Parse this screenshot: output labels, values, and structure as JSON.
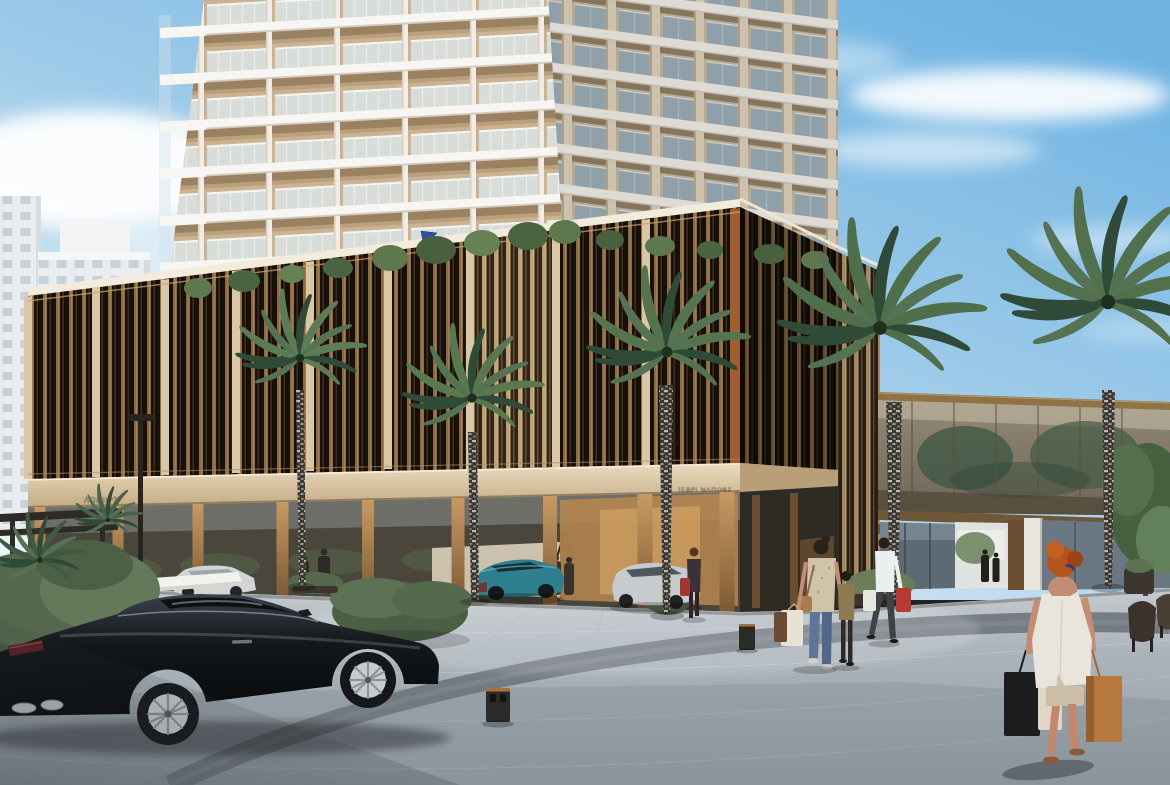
{
  "meta": {
    "domain": "Natural-Image",
    "kind": "architectural-exterior-render",
    "alt": "Daytime photorealistic rendering of a luxury mixed-use development: white residential tower with glass balconies above a bronze-louvred retail podium, palm-lined pedestrian plaza, shoppers with bags, a black luxury coupe in the foreground and a glazed sky-bridge on the right."
  },
  "scene": {
    "description": "Daytime rendering of a luxury residential tower with stacked white balconies rising above a two-storey retail podium wrapped in dark bronze vertical louvres; a palm-lined paved plaza with shoppers, parked luxury cars and a glazed sky-bridge connects the buildings.",
    "time_of_day": "day, clear blue sky with soft clouds",
    "signs": {
      "left": "ΛΟΩΙΙΡΣ",
      "center": "ΊΕΒΡΙ ΝΛΠΟΒΣ",
      "note": "fascia signage is illegible in the source render"
    },
    "elements": [
      "sky",
      "clouds",
      "distant white buildings",
      "residential tower with balconies",
      "bronze louvred retail podium",
      "storefront colonnade",
      "fascia signage",
      "blue pennant flag",
      "glazed sky-bridge",
      "palm trees",
      "pedestrian plaza",
      "curved paver band",
      "hedges and planters",
      "white entrance canopy",
      "street lamp pole",
      "litter bins",
      "outdoor chairs"
    ],
    "people": [
      "red-haired woman in white top carrying three shopping bags (foreground right)",
      "woman in jeans with child, carrying shopping bags (center)",
      "man in white shirt with red shopping bag (center right)",
      "woman in dark jacket with red bag (center left)",
      "doormen silhouettes at the entrance",
      "two figures beneath the sky-bridge"
    ],
    "vehicles": [
      "black luxury coupe (foreground)",
      "teal sports coupe",
      "silver car at entrance",
      "silver car behind hedge"
    ],
    "palette": {
      "sky_blue": "#79b5e3",
      "tower_white": "#f6f4f0",
      "balcony_beige": "#d2bb9a",
      "louver_bronze": "#8f6a3c",
      "louver_gold": "#d9ab70",
      "podium_dark": "#1b140d",
      "fascia_beige": "#e3d4b4",
      "plaza_gray": "#aab3ba",
      "paver_band_gray": "#6e757c",
      "palm_green": "#55744e",
      "trunk_gray": "#33312d",
      "car_black": "#14171b",
      "car_teal": "#2f808e",
      "car_silver": "#c9ccce",
      "hair_red": "#b4541d",
      "bag_tan": "#b5793f",
      "flag_blue": "#2e4f9e"
    }
  }
}
